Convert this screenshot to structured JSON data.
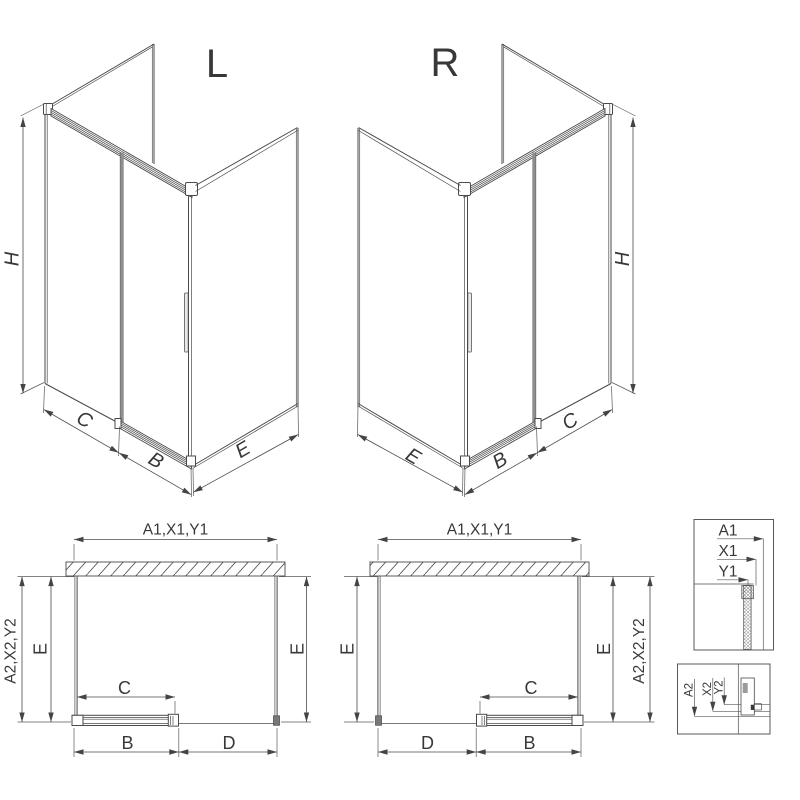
{
  "titles": {
    "left": "L",
    "right": "R"
  },
  "dims3d": {
    "h": "H",
    "c": "C",
    "b": "B",
    "e": "E"
  },
  "plan": {
    "a1": "A1,X1,Y1",
    "a2": "A2,X2,Y2",
    "e": "E",
    "c": "C",
    "b": "B",
    "d": "D"
  },
  "detail_top": {
    "a1": "A1",
    "x1": "X1",
    "y1": "Y1"
  },
  "detail_bottom": {
    "a2": "A2",
    "x2": "X2",
    "y2": "Y2"
  },
  "colors": {
    "line": "#4a4a4a",
    "text": "#383838",
    "glass_edge": "#8f8f8f",
    "background": "#ffffff"
  }
}
